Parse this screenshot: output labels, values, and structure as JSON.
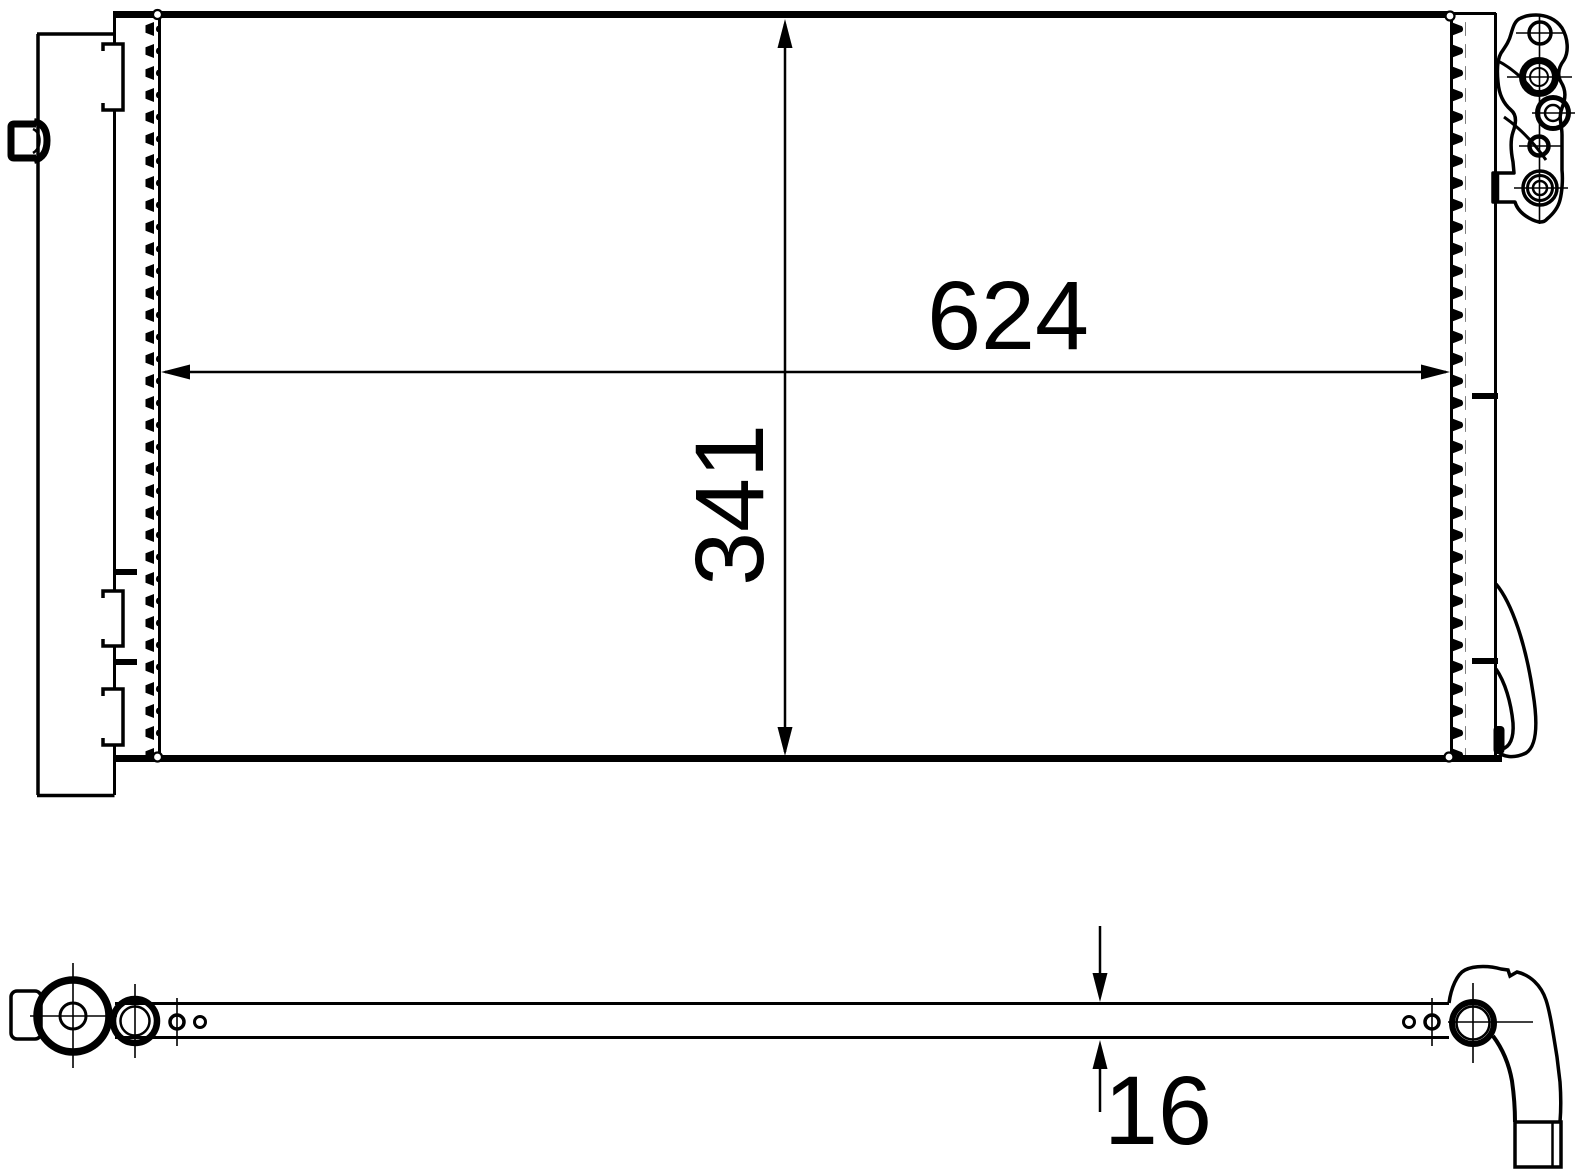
{
  "colors": {
    "background": "#ffffff",
    "line": "#000000"
  },
  "front_view": {
    "width_dimension_label": "624",
    "height_dimension_label": "341"
  },
  "side_view": {
    "thickness_dimension_label": "16"
  }
}
